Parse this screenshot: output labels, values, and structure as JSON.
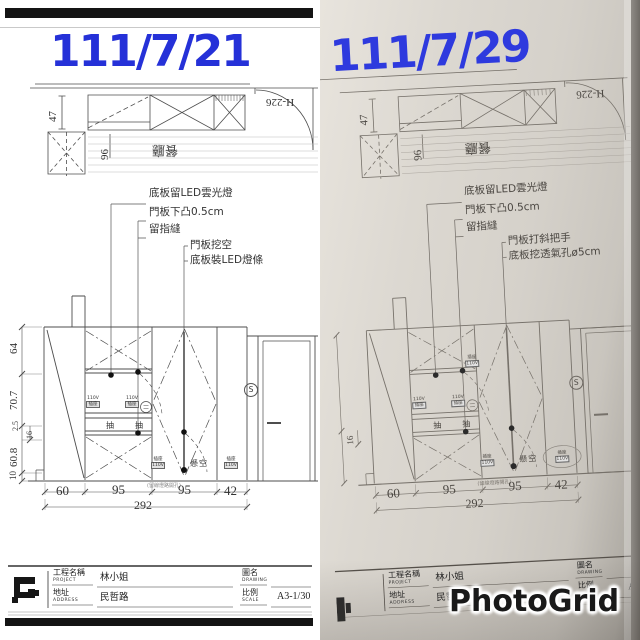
{
  "colors": {
    "date_blue": "#2531d8",
    "paper_tone": "#d6d2cb",
    "ink": "#4d4d4d"
  },
  "watermark": "PhotoGrid",
  "shared": {
    "plan": {
      "depth_dim": "47",
      "width_dim": "96",
      "room_label": "餐廳",
      "door_height_label": "H-226"
    },
    "elevation": {
      "outlet_v": "110V",
      "outlet_c": "插座",
      "drawer": "抽",
      "floating": "懸空",
      "switch_symbol": "S",
      "tiny_note": "(留線燈路開孔)"
    },
    "dims_h": {
      "segments": [
        "60",
        "95",
        "95",
        "42"
      ],
      "total": "292"
    },
    "dims_v": {
      "labels": [
        "64",
        "70.7",
        "2.5",
        "16",
        "60.8",
        "10"
      ]
    },
    "title_block": {
      "project_label": "工程名稱",
      "project_label_en": "PROJECT",
      "project_value": "林小姐",
      "address_label": "地址",
      "address_label_en": "ADDRESS",
      "address_value": "民哲路",
      "drawing_label": "圖名",
      "drawing_label_en": "DRAWING",
      "scale_label": "比例",
      "scale_label_en": "SCALE",
      "scale_value": "A3-1/30",
      "scale_value_cropped": "A3-1"
    }
  },
  "left_panel": {
    "date": "111/7/21",
    "annotations": [
      "底板留LED雲光燈",
      "門板下凸0.5cm",
      "留指縫",
      "門板挖空",
      "底板裝LED燈條"
    ]
  },
  "right_panel": {
    "date": "111/7/29",
    "annotations": [
      "底板留LED雲光燈",
      "門板下凸0.5cm",
      "留指縫",
      "門板打斜把手",
      "底板挖透氣孔ø5cm"
    ]
  }
}
